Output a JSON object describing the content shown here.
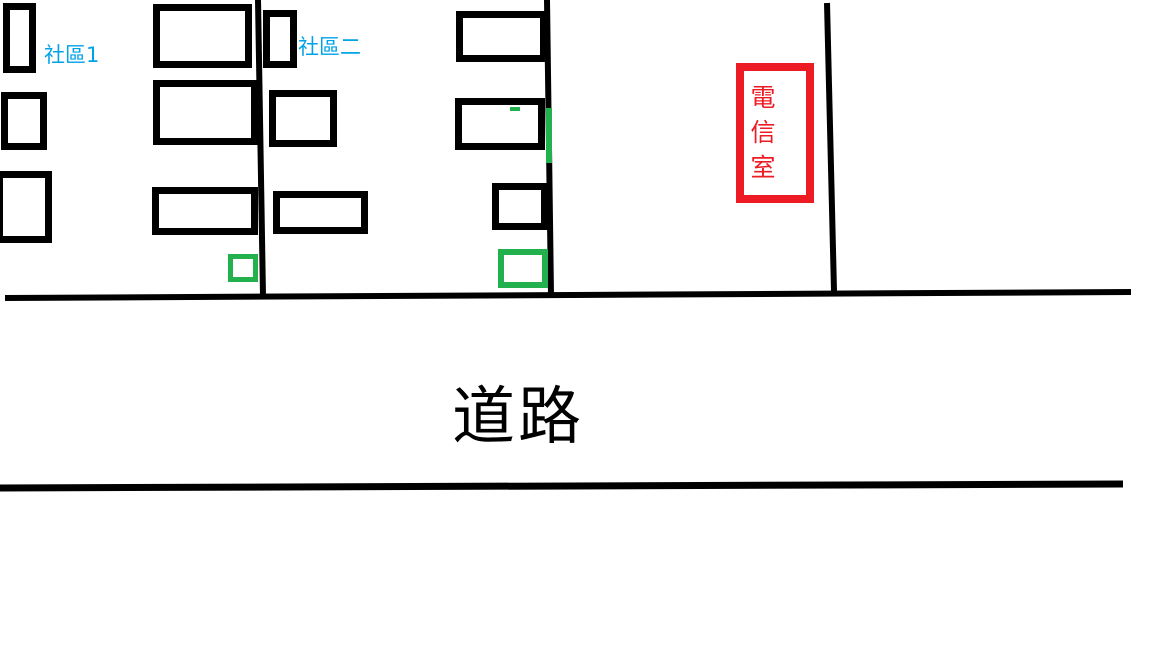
{
  "canvas": {
    "width": 1152,
    "height": 648,
    "background": "#ffffff"
  },
  "labels": {
    "community1": "社區1",
    "community2": "社區二",
    "telecom_room": "電信室",
    "telecom_chars": [
      "電",
      "信",
      "室"
    ],
    "road": "道路"
  },
  "colors": {
    "ink_black": "#000000",
    "label_blue": "#00A2E8",
    "highlight_green": "#22B14C",
    "telecom_red": "#ED1C24"
  },
  "shapes": {
    "buildings": [
      {
        "id": "building-left-1",
        "x": 3,
        "y": 3,
        "w": 33,
        "h": 70,
        "border": 7
      },
      {
        "id": "building-left-2",
        "x": 1,
        "y": 92,
        "w": 46,
        "h": 58,
        "border": 7
      },
      {
        "id": "building-left-3",
        "x": -4,
        "y": 171,
        "w": 56,
        "h": 72,
        "border": 7
      },
      {
        "id": "building-mid-1",
        "x": 153,
        "y": 4,
        "w": 99,
        "h": 64,
        "border": 7
      },
      {
        "id": "building-mid-2",
        "x": 263,
        "y": 10,
        "w": 34,
        "h": 58,
        "border": 7
      },
      {
        "id": "building-mid-3",
        "x": 153,
        "y": 80,
        "w": 105,
        "h": 65,
        "border": 7
      },
      {
        "id": "building-mid-4",
        "x": 269,
        "y": 90,
        "w": 68,
        "h": 57,
        "border": 7
      },
      {
        "id": "building-mid-5",
        "x": 152,
        "y": 187,
        "w": 106,
        "h": 48,
        "border": 7
      },
      {
        "id": "building-mid-6",
        "x": 273,
        "y": 191,
        "w": 95,
        "h": 43,
        "border": 7
      },
      {
        "id": "building-right-1",
        "x": 456,
        "y": 11,
        "w": 91,
        "h": 51,
        "border": 7
      },
      {
        "id": "building-right-2",
        "x": 455,
        "y": 98,
        "w": 90,
        "h": 52,
        "border": 7
      },
      {
        "id": "building-right-3",
        "x": 492,
        "y": 183,
        "w": 56,
        "h": 47,
        "border": 7
      }
    ],
    "telecom_box": {
      "id": "telecom-room-box",
      "x": 736,
      "y": 63,
      "w": 78,
      "h": 140,
      "border": 8
    },
    "green_marks": [
      {
        "id": "green-box-left",
        "type": "outline",
        "x": 228,
        "y": 254,
        "w": 30,
        "h": 28,
        "border": 5
      },
      {
        "id": "green-box-center",
        "type": "outline",
        "x": 498,
        "y": 249,
        "w": 50,
        "h": 39,
        "border": 6
      },
      {
        "id": "green-line-vertical",
        "type": "solid",
        "x": 546,
        "y": 108,
        "w": 6,
        "h": 55
      },
      {
        "id": "green-dash",
        "type": "solid",
        "x": 510,
        "y": 107,
        "w": 10,
        "h": 4
      }
    ],
    "lines": [
      {
        "id": "boundary-line-left",
        "x1": 258,
        "y1": 0,
        "x2": 263,
        "y2": 296,
        "width": 6
      },
      {
        "id": "boundary-line-center",
        "x1": 547,
        "y1": 0,
        "x2": 551,
        "y2": 295,
        "width": 6
      },
      {
        "id": "boundary-line-right",
        "x1": 827,
        "y1": 3,
        "x2": 834,
        "y2": 291,
        "width": 6
      },
      {
        "id": "road-edge-top",
        "x1": 5,
        "y1": 298,
        "x2": 1131,
        "y2": 292,
        "width": 6
      },
      {
        "id": "road-edge-bottom",
        "x1": 0,
        "y1": 488,
        "x2": 1123,
        "y2": 484,
        "width": 7
      }
    ]
  }
}
